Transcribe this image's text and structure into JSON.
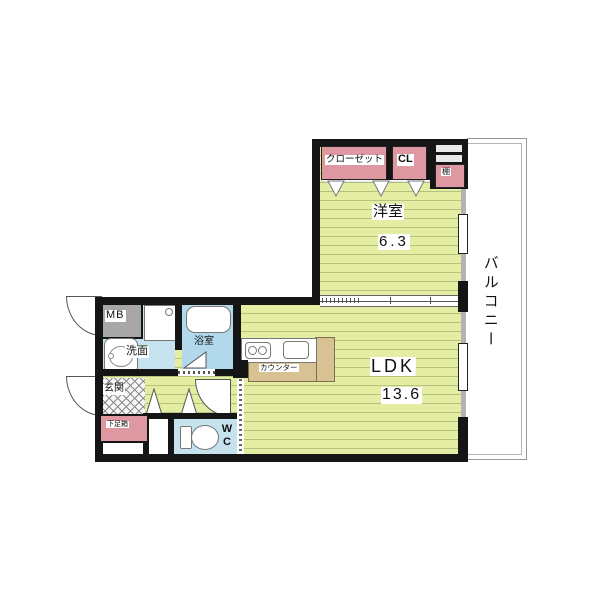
{
  "floorplan": {
    "title": "1LDK apartment floor plan",
    "labels": {
      "western_room": "洋室",
      "western_room_size": "6.3",
      "ldk": "LDK",
      "ldk_size": "13.6",
      "balcony": "バルコニー",
      "closet": "クローゼット",
      "cl": "CL",
      "shelf": "棚",
      "meter_box": "MB",
      "washroom": "洗面",
      "bathroom": "浴室",
      "entrance": "玄関",
      "shoe_box": "下足箱",
      "wc": "WC",
      "counter": "カウンター"
    },
    "colors": {
      "floor_base": "#e4eda1",
      "floor_stripe": "#b4c381",
      "wall_black": "#151515",
      "wall_gray": "#b3b3b3",
      "closet_pink": "#de98a2",
      "water_blue": "#c6e2ef",
      "bath_blue": "#b2d8ec",
      "meter_box_gray": "#a7a7a7",
      "counter_tan": "#d8c193",
      "balcony_border": "#999999",
      "background": "#ffffff"
    }
  }
}
